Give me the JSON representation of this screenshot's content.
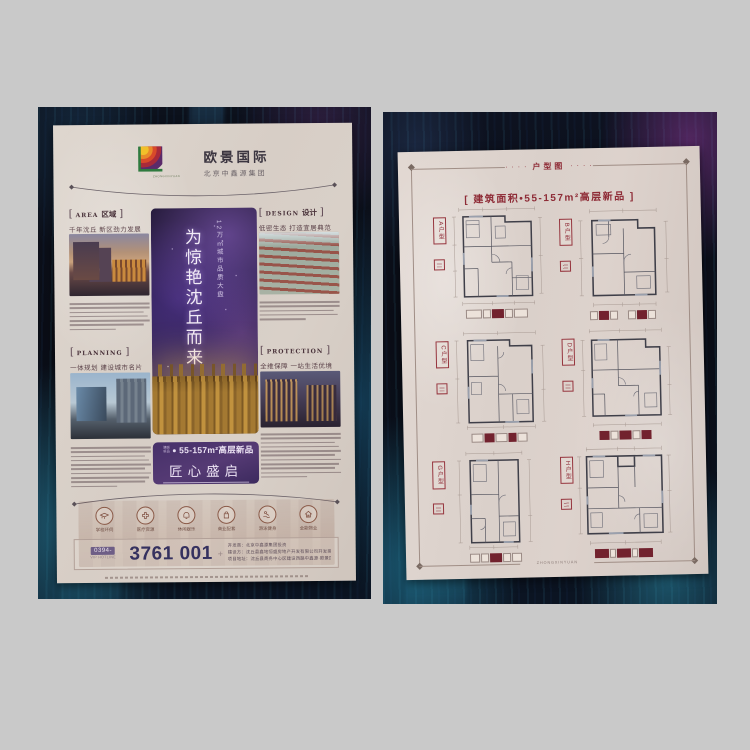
{
  "ui": {
    "bl": "[",
    "br": "]",
    "dots": "· · · ·",
    "plus": "+"
  },
  "colors": {
    "accent_maroon": "#8e2b36",
    "accent_purple": "#4a3566",
    "navy": "#35315f",
    "paper": "#d9d0c9"
  },
  "left_page": {
    "brand": {
      "name": "欧景国际",
      "company": "北京中鑫源集团",
      "logo_caption": "ZHONGXINYUAN"
    },
    "sections": {
      "area": {
        "en": "Area",
        "cn": "区域",
        "subtitle": "千年沈丘 新区劲力发展"
      },
      "design": {
        "en": "Design",
        "cn": "设计",
        "subtitle": "低密生态 打造宜居典范"
      },
      "planning": {
        "en": "Planning",
        "cn": "",
        "subtitle": "一体规划 建设城市名片"
      },
      "protection": {
        "en": "Protection",
        "cn": "",
        "subtitle": "全维保障 一站生活优境"
      }
    },
    "hero": {
      "eyebrow_vertical": "12万㎡城市品质大盘",
      "title_vertical": "为惊艳沈丘而来",
      "prefix_top": "建面",
      "prefix_bottom": "新品",
      "product": "55-157m²高层新品",
      "slogan": "匠心盛启"
    },
    "amenities": [
      {
        "label": "学校环伺",
        "icon": "school-icon"
      },
      {
        "label": "医疗资源",
        "icon": "medical-icon"
      },
      {
        "label": "休闲娱乐",
        "icon": "leisure-icon"
      },
      {
        "label": "商业配套",
        "icon": "shopping-icon"
      },
      {
        "label": "游泳健身",
        "icon": "fitness-icon"
      },
      {
        "label": "全能物业",
        "icon": "property-icon"
      }
    ],
    "contact": {
      "area_code": "0394-",
      "hotline_label": "VIP HOTLINE",
      "phone": "3761 001",
      "info": [
        "开发商：北京中鑫源集团投资",
        "建设方：沈丘县鑫地恒盛房地产开发有限公司开发建设",
        "项目地址：沈丘县商务中心区建设西路中鑫源·欧景国际"
      ]
    }
  },
  "right_page": {
    "header": "户型图",
    "title": "[ 建筑面积•55-157m²高层新品 ]",
    "plans": [
      {
        "label": "A户型"
      },
      {
        "label": "B户型"
      },
      {
        "label": "C户型"
      },
      {
        "label": "D户型"
      },
      {
        "label": "G户型"
      },
      {
        "label": "H户型"
      }
    ],
    "footer": "ZHONGXINYUAN"
  }
}
